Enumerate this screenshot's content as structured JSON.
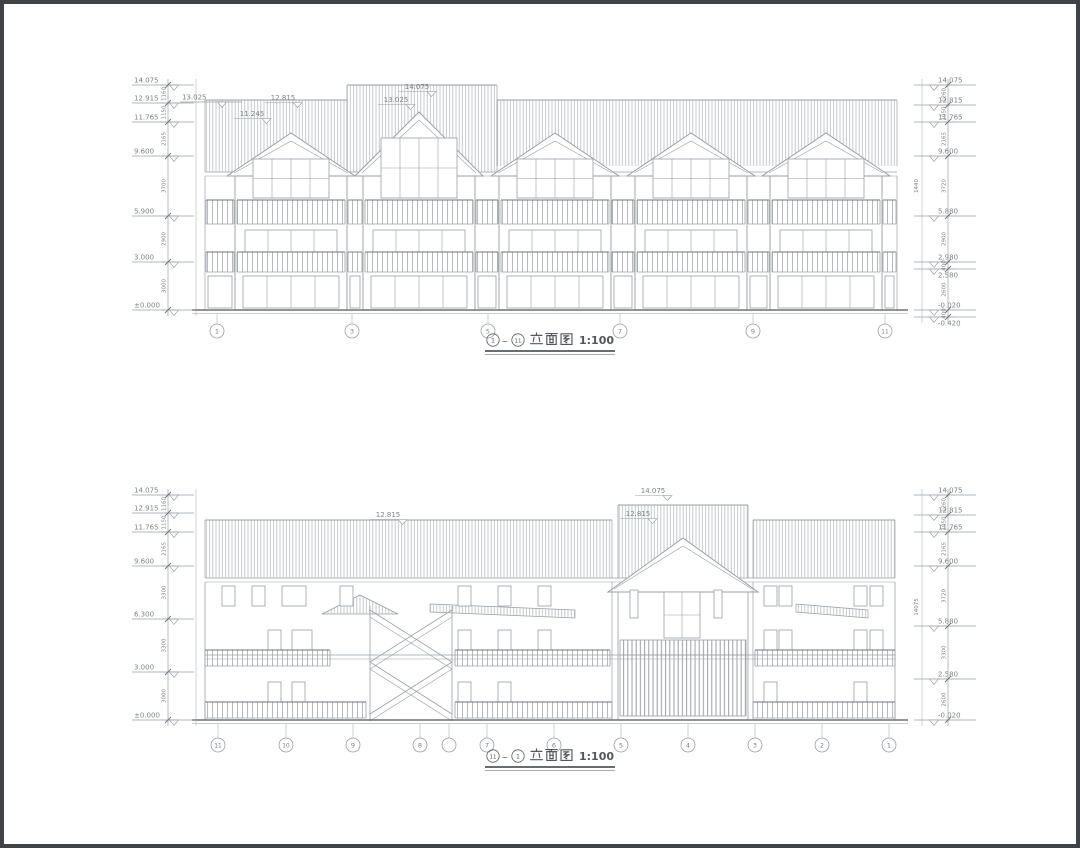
{
  "colors": {
    "line": "#9aa0a6",
    "line_dark": "#6d7278",
    "hatch": "#b7bdc3",
    "text": "#7d8287",
    "title_text": "#54585c",
    "background": "#ffffff",
    "frame": "#3f4347"
  },
  "top_view": {
    "title": {
      "axis_from": "1",
      "tilde": "~",
      "axis_to": "11",
      "label": "立面图",
      "scale": "1:100"
    },
    "axes": [
      {
        "label": "1",
        "x": 217
      },
      {
        "label": "3",
        "x": 352
      },
      {
        "label": "5",
        "x": 488
      },
      {
        "label": "7",
        "x": 620
      },
      {
        "label": "9",
        "x": 753
      },
      {
        "label": "11",
        "x": 885
      }
    ],
    "levels_left": [
      {
        "label": "14.075",
        "y": 85
      },
      {
        "label": "12.915",
        "y": 103
      },
      {
        "label": "11.765",
        "y": 122
      },
      {
        "label": "9.600",
        "y": 156
      },
      {
        "label": "5.900",
        "y": 216
      },
      {
        "label": "3.000",
        "y": 262
      },
      {
        "label": "±0.000",
        "y": 310
      }
    ],
    "levels_left_inner": [
      {
        "label": "13.025",
        "y": 102
      }
    ],
    "dims_left": [
      "1160",
      "1150",
      "2165",
      "3700",
      "2900",
      "3000"
    ],
    "levels_right": [
      {
        "label": "14.075",
        "y": 85
      },
      {
        "label": "12.815",
        "y": 105
      },
      {
        "label": "11.765",
        "y": 122
      },
      {
        "label": "9.600",
        "y": 156
      },
      {
        "label": "5.880",
        "y": 216
      },
      {
        "label": "2.980",
        "y": 262
      },
      {
        "label": "2.580",
        "y": 269,
        "below": true
      },
      {
        "label": "-0.020",
        "y": 310
      },
      {
        "label": "-0.420",
        "y": 317,
        "below": true
      }
    ],
    "dims_right": [
      "1260",
      "1050",
      "2165",
      "3720",
      "2900",
      "400",
      "2600",
      "400"
    ],
    "inner_dims_right": [
      {
        "label": "1440",
        "y": 186
      }
    ],
    "annotations": [
      {
        "label": "12.815",
        "x": 283,
        "y": 100
      },
      {
        "label": "11.245",
        "x": 252,
        "y": 116
      },
      {
        "label": "14.075",
        "x": 417,
        "y": 89
      },
      {
        "label": "13.025",
        "x": 396,
        "y": 102
      }
    ]
  },
  "bottom_view": {
    "title": {
      "axis_from": "11",
      "tilde": "~",
      "axis_to": "1",
      "label": "立面图",
      "scale": "1:100"
    },
    "axes": [
      {
        "label": "11",
        "x": 218
      },
      {
        "label": "10",
        "x": 286
      },
      {
        "label": "9",
        "x": 353
      },
      {
        "label": "8",
        "x": 420
      },
      {
        "label": "",
        "x": 449
      },
      {
        "label": "7",
        "x": 487
      },
      {
        "label": "6",
        "x": 554
      },
      {
        "label": "5",
        "x": 621
      },
      {
        "label": "4",
        "x": 688
      },
      {
        "label": "3",
        "x": 755
      },
      {
        "label": "2",
        "x": 822
      },
      {
        "label": "1",
        "x": 889
      }
    ],
    "levels_left": [
      {
        "label": "14.075",
        "y": 495
      },
      {
        "label": "12.915",
        "y": 513
      },
      {
        "label": "11.765",
        "y": 532
      },
      {
        "label": "9.600",
        "y": 566
      },
      {
        "label": "6.300",
        "y": 619
      },
      {
        "label": "3.000",
        "y": 672
      },
      {
        "label": "±0.000",
        "y": 720
      }
    ],
    "dims_left": [
      "1160",
      "1150",
      "2165",
      "3300",
      "3300",
      "3000"
    ],
    "levels_right": [
      {
        "label": "14.075",
        "y": 495
      },
      {
        "label": "12.815",
        "y": 515
      },
      {
        "label": "11.765",
        "y": 532
      },
      {
        "label": "9.600",
        "y": 566
      },
      {
        "label": "5.880",
        "y": 626
      },
      {
        "label": "2.580",
        "y": 679
      },
      {
        "label": "-0.020",
        "y": 720
      }
    ],
    "dims_right": [
      "1260",
      "1050",
      "2165",
      "3720",
      "3300",
      "2600"
    ],
    "total_dim_right": {
      "label": "14075",
      "y": 607
    },
    "annotations": [
      {
        "label": "12.815",
        "x": 388,
        "y": 517
      },
      {
        "label": "14.075",
        "x": 653,
        "y": 493
      },
      {
        "label": "12.815",
        "x": 638,
        "y": 516
      }
    ]
  }
}
